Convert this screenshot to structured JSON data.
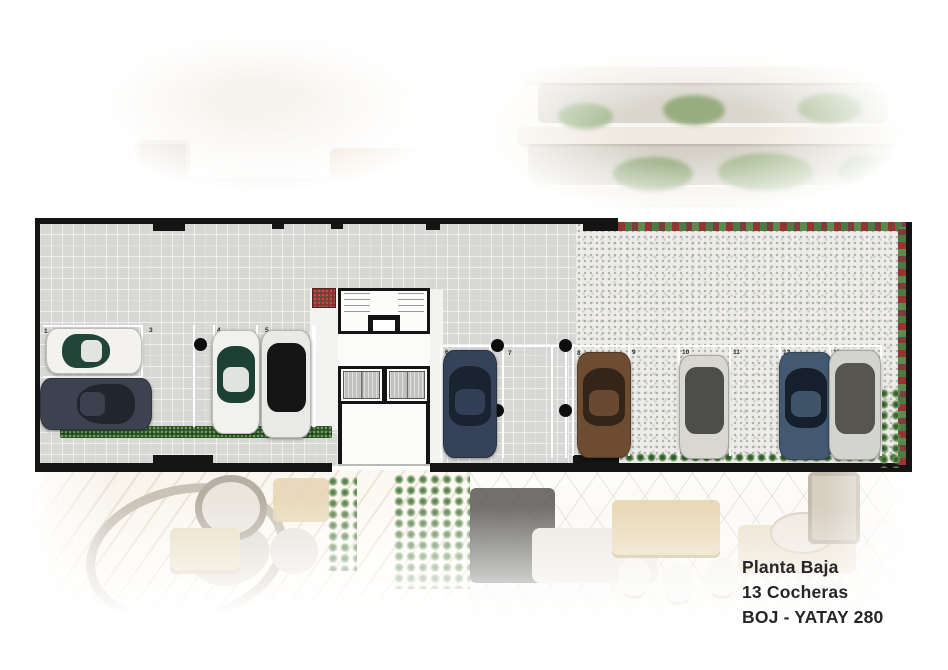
{
  "caption": {
    "line1": "Planta Baja",
    "line2": "13 Cocheras",
    "line3": "BOJ - YATAY 280"
  },
  "plan": {
    "type": "ground-floor parking plan",
    "space_numbers": [
      "1",
      "2",
      "3",
      "4",
      "5",
      "6",
      "7",
      "8",
      "9",
      "10",
      "11",
      "12",
      "13"
    ],
    "occupied_spaces": [
      "1",
      "2",
      "4",
      "5",
      "6",
      "8",
      "10",
      "12",
      "13"
    ],
    "empty_spaces": [
      "3",
      "7",
      "9",
      "11"
    ],
    "colors": {
      "wall": "#141414",
      "garage_floor": "#d7d7d5",
      "patio_floor": "#edece8",
      "parking_line": "#ffffff",
      "hedge_green": "#2c532c",
      "flower_red": "#8f2f2f"
    },
    "cars": [
      {
        "space": "1",
        "body": "#f3f2ee",
        "glass": "#214538"
      },
      {
        "space": "2",
        "body": "#3d4250",
        "glass": "#21252e"
      },
      {
        "space": "4",
        "body": "#f1f1ed",
        "glass": "#1d4034"
      },
      {
        "space": "5",
        "body": "#e9e9e7",
        "glass": "#151515"
      },
      {
        "space": "6",
        "body": "#35425a",
        "glass": "#1a2330"
      },
      {
        "space": "8",
        "body": "#6e4c32",
        "glass": "#34251b"
      },
      {
        "space": "10",
        "body": "#d8d7d2",
        "glass": "#4d4d4b"
      },
      {
        "space": "12",
        "body": "#43596f",
        "glass": "#16202c"
      },
      {
        "space": "13",
        "body": "#d3d3cf",
        "glass": "#56564f"
      }
    ],
    "core": {
      "elevator_count": 2
    }
  }
}
